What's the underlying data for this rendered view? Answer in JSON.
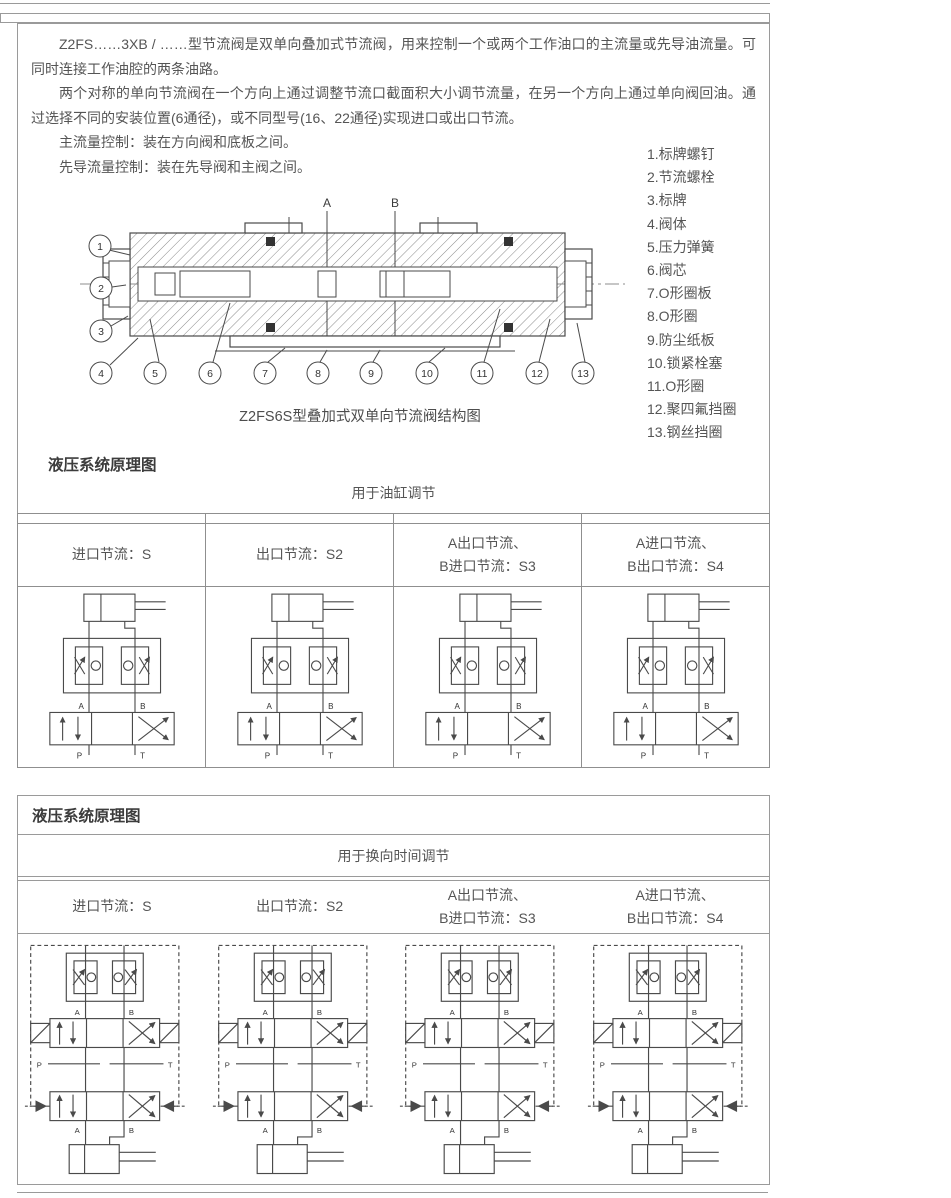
{
  "intro": {
    "paragraphs": [
      "Z2FS……3XB / ……型节流阀是双单向叠加式节流阀，用来控制一个或两个工作油口的主流量或先导油流量。可同时连接工作油腔的两条油路。",
      "两个对称的单向节流阀在一个方向上通过调整节流口截面积大小调节流量，在另一个方向上通过单向阀回油。通过选择不同的安装位置(6通径)，或不同型号(16、22通径)实现进口或出口节流。",
      "主流量控制：装在方向阀和底板之间。",
      "先导流量控制：装在先导阀和主阀之间。"
    ]
  },
  "diagram": {
    "caption": "Z2FS6S型叠加式双单向节流阀结构图",
    "port_a": "A",
    "port_b": "B",
    "callouts": [
      "1",
      "2",
      "3",
      "4",
      "5",
      "6",
      "7",
      "8",
      "9",
      "10",
      "11",
      "12",
      "13"
    ],
    "parts": [
      "1.标牌螺钉",
      "2.节流螺栓",
      "3.标牌",
      "4.阀体",
      "5.压力弹簧",
      "6.阀芯",
      "7.O形圈板",
      "8.O形圈",
      "9.防尘纸板",
      "10.锁紧栓塞",
      "11.O形圈",
      "12.聚四氟挡圈",
      "13.钢丝挡圈"
    ]
  },
  "valve_labels": {
    "a": "A",
    "b": "B",
    "p": "P",
    "t": "T"
  },
  "section1": {
    "title": "液压系统原理图",
    "subtitle": "用于油缸调节",
    "headers": [
      {
        "line1": "进口节流：S",
        "line2": ""
      },
      {
        "line1": "出口节流：S2",
        "line2": ""
      },
      {
        "line1": "A出口节流、",
        "line2": "B进口节流：S3"
      },
      {
        "line1": "A进口节流、",
        "line2": "B出口节流：S4"
      }
    ]
  },
  "section2": {
    "title": "液压系统原理图",
    "subtitle": "用于换向时间调节",
    "headers": [
      {
        "line1": "进口节流：S",
        "line2": ""
      },
      {
        "line1": "出口节流：S2",
        "line2": ""
      },
      {
        "line1": "A出口节流、",
        "line2": "B进口节流：S3"
      },
      {
        "line1": "A进口节流、",
        "line2": "B出口节流：S4"
      }
    ]
  },
  "colors": {
    "border": "#9a9a9a",
    "line": "#4a4a4a",
    "text": "#555555"
  }
}
